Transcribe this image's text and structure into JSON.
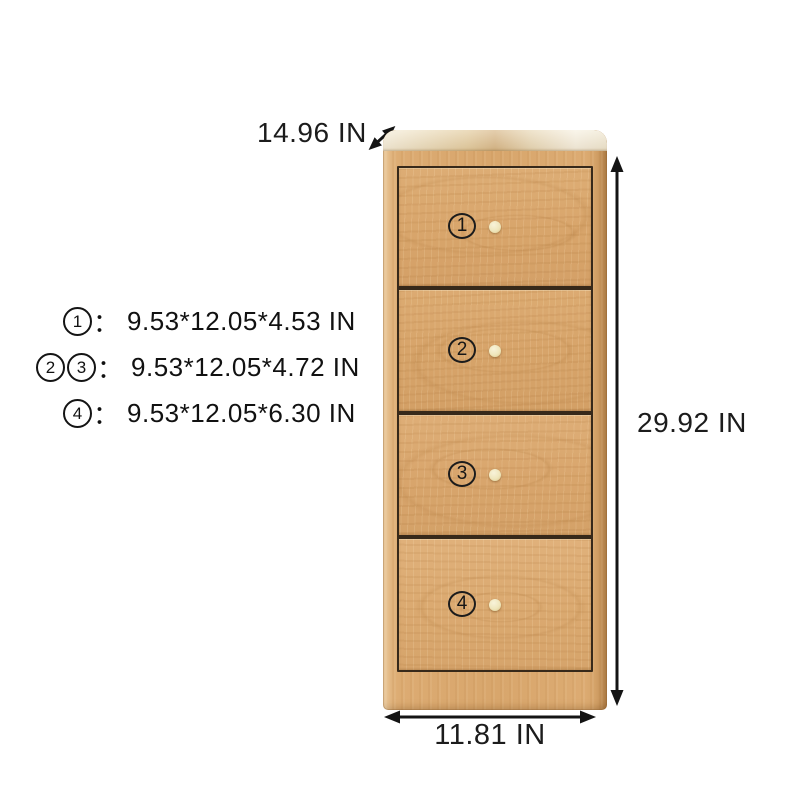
{
  "dimensions": {
    "depth_label": "14.96 IN",
    "height_label": "29.92 IN",
    "width_label": "11.81 IN"
  },
  "spec_list": {
    "separator": "：",
    "lines": [
      {
        "badges": [
          "1"
        ],
        "text": "9.53*12.05*4.53 IN"
      },
      {
        "badges": [
          "2",
          "3"
        ],
        "text": "9.53*12.05*4.72 IN"
      },
      {
        "badges": [
          "4"
        ],
        "text": "9.53*12.05*6.30 IN"
      }
    ]
  },
  "drawers": [
    {
      "number": "1"
    },
    {
      "number": "2"
    },
    {
      "number": "3"
    },
    {
      "number": "4"
    }
  ],
  "colors": {
    "background": "#ffffff",
    "wood_front": "#d8a56b",
    "wood_edge_dark": "#cf9c61",
    "wood_top_surface": "#eddfc0",
    "drawer_gap": "#37291a",
    "knob": "#efe6bc",
    "annotation": "#141414"
  }
}
